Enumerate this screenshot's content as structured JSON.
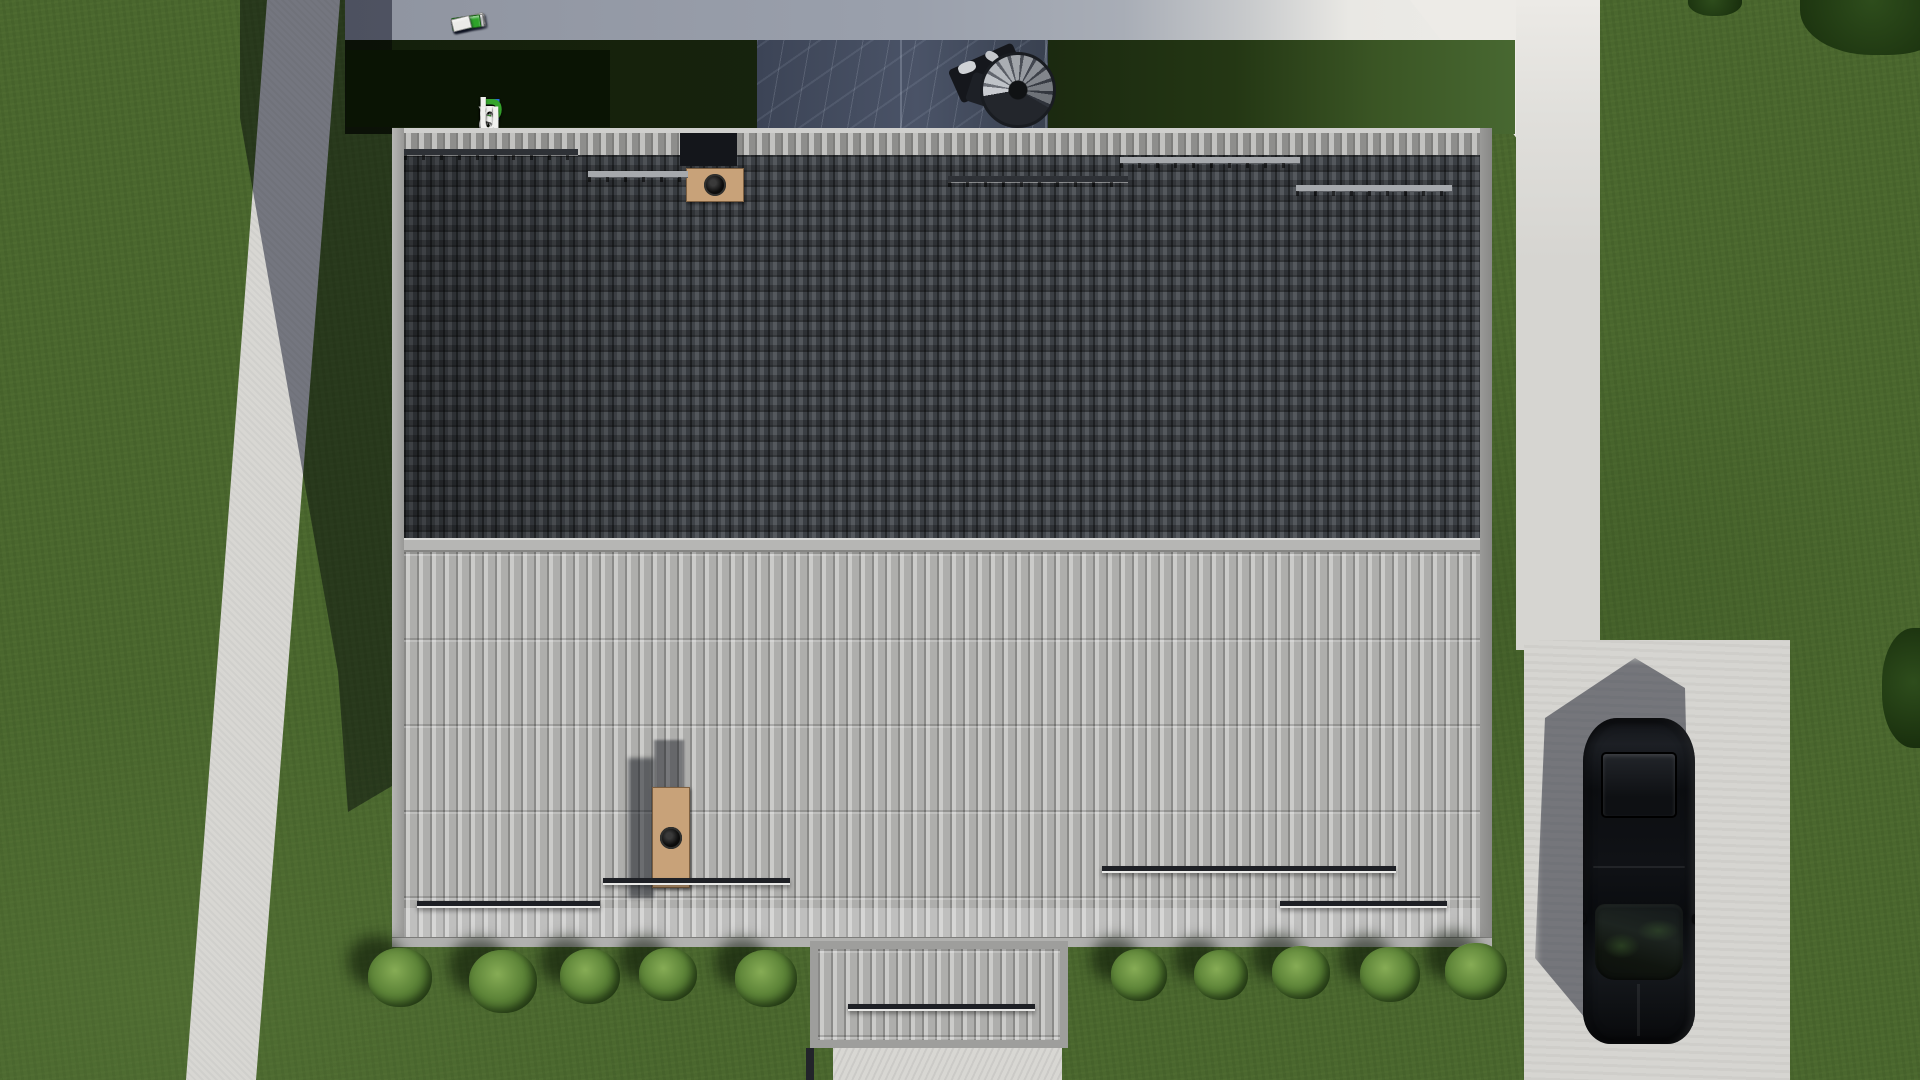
{
  "watermark": {
    "text": "FixPlans.ru",
    "background": "#0a1404",
    "letters": [
      {
        "ch": "F",
        "color": "#2b6ce0"
      },
      {
        "ch": "i",
        "color": "#f1f1ef"
      },
      {
        "ch": "x",
        "color": "#f1f1ef"
      },
      {
        "ch": "P",
        "color": "#35a42c"
      },
      {
        "ch": "l",
        "color": "#f1f1ef"
      },
      {
        "ch": "a",
        "color": "#f1f1ef"
      },
      {
        "ch": "n",
        "color": "#f1f1ef"
      },
      {
        "ch": "s",
        "color": "#f1f1ef"
      },
      {
        "ch": ".",
        "color": "#2b6ce0"
      },
      {
        "ch": "r",
        "color": "#f1f1ef"
      },
      {
        "ch": "u",
        "color": "#f1f1ef"
      }
    ]
  },
  "mini_logo": {
    "blocks": [
      {
        "w": 34,
        "color": "#efefed"
      },
      {
        "w": 16,
        "color": "#eaeae8"
      },
      {
        "w": 14,
        "color": "#2563d6"
      },
      {
        "w": 33,
        "color": "#ececea"
      },
      {
        "w": 32,
        "color": "#e9e9e7"
      },
      {
        "w": 9,
        "color": "#e6e6e4"
      },
      {
        "w": 29,
        "color": "#2ea32a"
      },
      {
        "w": 19,
        "color": "#eaeae8"
      }
    ]
  },
  "roof": {
    "upper_tile_color": "#3c4043",
    "lower_tile_color": "#b0b0ae",
    "ridge_color": "#b6b6b4",
    "fascia_color": "#a5a5a3"
  },
  "chimneys": {
    "brick_color": "#c8a279",
    "top": {
      "flues": 2
    },
    "bottom": {
      "flues": 4
    }
  },
  "snow_rails": {
    "upper": [
      {
        "x": 404,
        "y": 149,
        "w": 174,
        "light": false
      },
      {
        "x": 588,
        "y": 171,
        "w": 100,
        "light": true
      },
      {
        "x": 948,
        "y": 176,
        "w": 180,
        "light": false
      },
      {
        "x": 1120,
        "y": 157,
        "w": 180,
        "light": true
      },
      {
        "x": 1296,
        "y": 185,
        "w": 156,
        "light": true
      }
    ],
    "lower": [
      {
        "x": 417,
        "y": 901,
        "w": 183
      },
      {
        "x": 603,
        "y": 878,
        "w": 187
      },
      {
        "x": 1102,
        "y": 866,
        "w": 294
      },
      {
        "x": 1280,
        "y": 901,
        "w": 167
      },
      {
        "x": 848,
        "y": 1004,
        "w": 187
      }
    ]
  },
  "bushes": [
    [
      400,
      977,
      32
    ],
    [
      503,
      981,
      34
    ],
    [
      590,
      977,
      30
    ],
    [
      668,
      975,
      29
    ],
    [
      766,
      979,
      31
    ],
    [
      1139,
      975,
      28
    ],
    [
      1221,
      975,
      27
    ],
    [
      1301,
      973,
      29
    ],
    [
      1390,
      975,
      30
    ],
    [
      1476,
      972,
      31
    ]
  ],
  "foliage": [
    {
      "x": 1800,
      "y": -45,
      "w": 160,
      "h": 100
    },
    {
      "x": 1688,
      "y": -14,
      "w": 54,
      "h": 30
    },
    {
      "x": 1882,
      "y": 628,
      "w": 70,
      "h": 120
    }
  ],
  "ground": {
    "grass_color": "#4a672e",
    "concrete_color": "#d8d7d3",
    "shadow_color": "rgba(28,34,60,0.52)"
  },
  "car": {
    "body_color": "#0b0c0e"
  }
}
